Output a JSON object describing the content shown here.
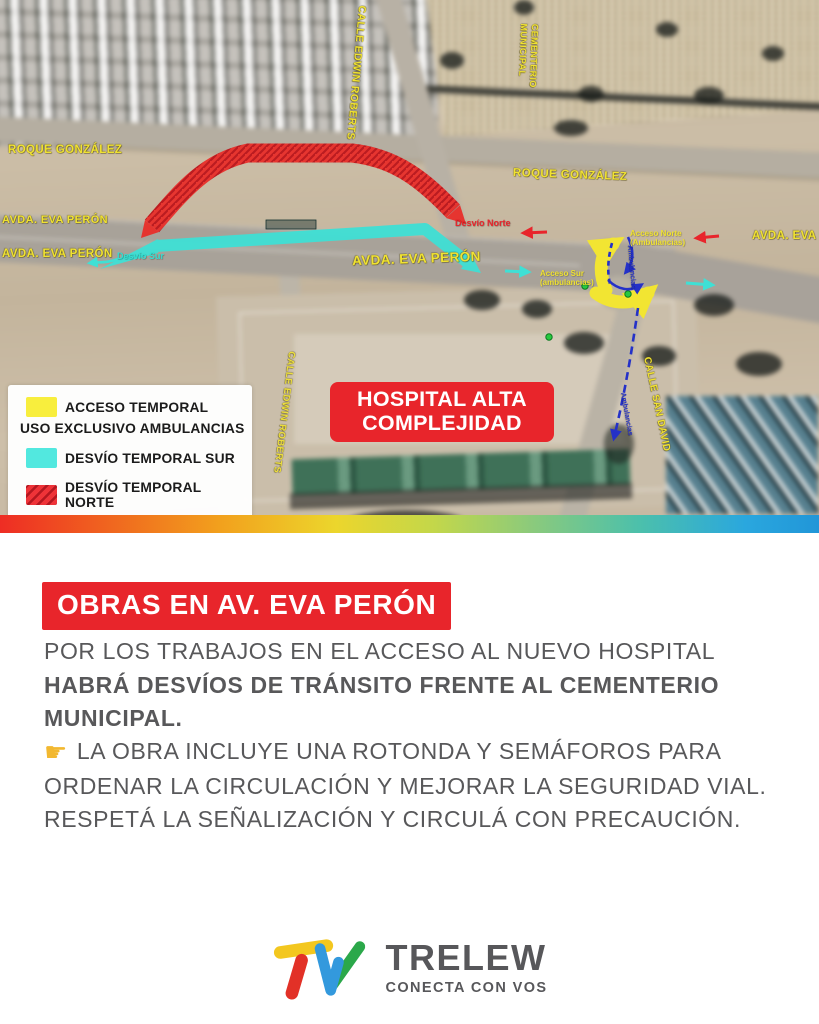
{
  "map": {
    "street_labels": {
      "roque_left": "ROQUE GONZÁLEZ",
      "roque_right": "ROQUE GONZÁLEZ",
      "edwin_top": "CALLE EDWIN ROBERTS",
      "edwin_bottom": "CALLE EDWIN ROBERTS",
      "cementerio_line1": "CEMENTERIO",
      "cementerio_line2": "MUNICIPAL",
      "eva_left1": "AVDA. EVA PERÓN",
      "eva_left2": "AVDA. EVA PERÓN",
      "eva_center": "AVDA. EVA PERÓN",
      "eva_right": "AVDA. EVA PERÓN",
      "san_david": "CALLE SAN DAVID"
    },
    "route_labels": {
      "desvio_norte": "Desvío Norte",
      "desvio_sur": "Desvío Sur",
      "acceso_norte_l1": "Acceso Norte",
      "acceso_norte_l2": "(Ambulancias)",
      "acceso_sur_l1": "Acceso Sur",
      "acceso_sur_l2": "(ambulancias)",
      "ambulancias_top": "Ambulancias",
      "ambulancias_bottom": "Ambulancias"
    },
    "hospital_badge": {
      "line1": "HOSPITAL ALTA",
      "line2": "COMPLEJIDAD"
    },
    "legend": {
      "item1_line1": "ACCESO TEMPORAL",
      "item1_line2": "USO EXCLUSIVO AMBULANCIAS",
      "item2": "DESVÍO TEMPORAL SUR",
      "item3": "DESVÍO TEMPORAL NORTE"
    }
  },
  "content": {
    "title": "OBRAS EN AV. EVA PERÓN",
    "paragraph1_regular": "POR LOS TRABAJOS EN EL ACCESO AL NUEVO HOSPITAL ",
    "paragraph1_bold": "HABRÁ DESVÍOS DE TRÁNSITO FRENTE AL CEMENTERIO MUNICIPAL.",
    "paragraph2_icon": "☛",
    "paragraph2_text": " LA OBRA INCLUYE UNA ROTONDA Y SEMÁFOROS PARA ORDENAR LA CIRCULACIÓN Y MEJORAR LA SEGURIDAD VIAL. RESPETÁ LA SEÑALIZACIÓN Y CIRCULÁ CON PRECAUCIÓN."
  },
  "footer": {
    "brand": "TRELEW",
    "tagline": "CONECTA CON VOS"
  },
  "colors": {
    "accent_red": "#e8252b",
    "detour_north_red": "#e92f2a",
    "detour_south_cyan": "#3fe0d5",
    "access_yellow": "#f2e532",
    "map_label_yellow": "#f0e232",
    "ambulance_route_blue": "#2431c8",
    "body_text_gray": "#58585a"
  }
}
